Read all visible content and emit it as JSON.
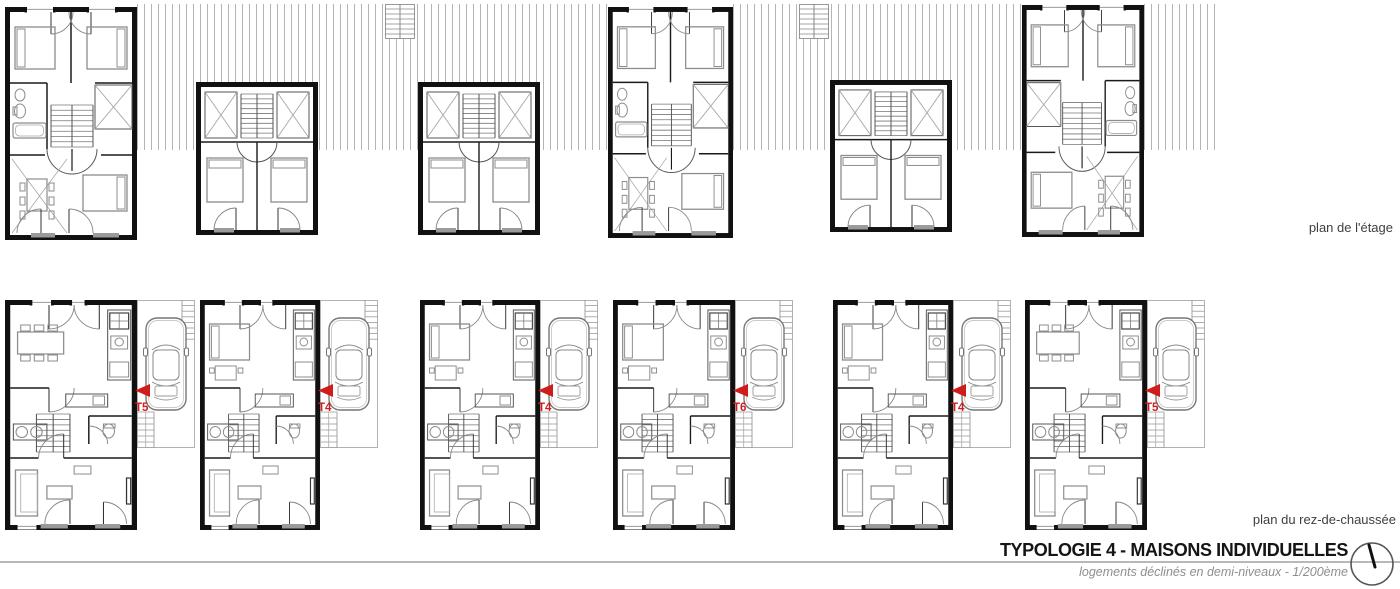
{
  "title_block": {
    "title": "TYPOLOGIE 4 - MAISONS INDIVIDUELLES",
    "subtitle": "logements déclinés en demi-niveaux - 1/200ème"
  },
  "captions": {
    "upper": "plan de l'étage",
    "lower": "plan du rez-de-chaussée"
  },
  "colors": {
    "wall": "#111111",
    "line": "#555555",
    "furniture": "#8c8c8c",
    "faint": "#a8a8a8",
    "hatch": "#b4b4b4",
    "threshold": "#9a9a9a",
    "accent_red": "#cf1d1d",
    "rule": "#b8b8b8",
    "caption": "#3f3f3f"
  },
  "upper_floor": {
    "houses": [
      {
        "id": "etage-1",
        "type": "floor-large",
        "mirror": false,
        "x": 5,
        "y": 7,
        "w": 132,
        "h": 233
      },
      {
        "id": "etage-2",
        "type": "floor-small",
        "mirror": false,
        "x": 196,
        "y": 82,
        "w": 122,
        "h": 153
      },
      {
        "id": "etage-3",
        "type": "floor-small",
        "mirror": false,
        "x": 418,
        "y": 82,
        "w": 122,
        "h": 153
      },
      {
        "id": "etage-4",
        "type": "floor-large",
        "mirror": false,
        "x": 608,
        "y": 7,
        "w": 125,
        "h": 231
      },
      {
        "id": "etage-5",
        "type": "floor-small",
        "mirror": false,
        "x": 830,
        "y": 80,
        "w": 122,
        "h": 152
      },
      {
        "id": "etage-6",
        "type": "floor-large",
        "mirror": true,
        "x": 1022,
        "y": 5,
        "w": 122,
        "h": 232
      }
    ],
    "roof_strips": [
      {
        "x": 137,
        "y": 4,
        "w": 471,
        "h": 146
      },
      {
        "x": 733,
        "y": 4,
        "w": 289,
        "h": 146
      },
      {
        "x": 1144,
        "y": 4,
        "w": 72,
        "h": 146
      }
    ],
    "exterior_stairs": [
      {
        "x": 385,
        "y": 4,
        "w": 30,
        "h": 35
      },
      {
        "x": 799,
        "y": 4,
        "w": 30,
        "h": 35
      }
    ]
  },
  "ground_floor": {
    "houses": [
      {
        "id": "rdc-1",
        "unit": "T5",
        "variant": "dining",
        "x": 5,
        "y": 300,
        "w": 132,
        "h": 230
      },
      {
        "id": "rdc-2",
        "unit": "T4",
        "variant": "bed",
        "x": 200,
        "y": 300,
        "w": 120,
        "h": 230
      },
      {
        "id": "rdc-3",
        "unit": "T4",
        "variant": "bed",
        "x": 420,
        "y": 300,
        "w": 120,
        "h": 230
      },
      {
        "id": "rdc-4",
        "unit": "T6",
        "variant": "bed",
        "x": 613,
        "y": 300,
        "w": 122,
        "h": 230
      },
      {
        "id": "rdc-5",
        "unit": "T4",
        "variant": "bed",
        "x": 833,
        "y": 300,
        "w": 120,
        "h": 230
      },
      {
        "id": "rdc-6",
        "unit": "T5",
        "variant": "dining",
        "x": 1025,
        "y": 300,
        "w": 122,
        "h": 230
      }
    ],
    "parking_pad": {
      "w": 58,
      "h": 148
    }
  }
}
